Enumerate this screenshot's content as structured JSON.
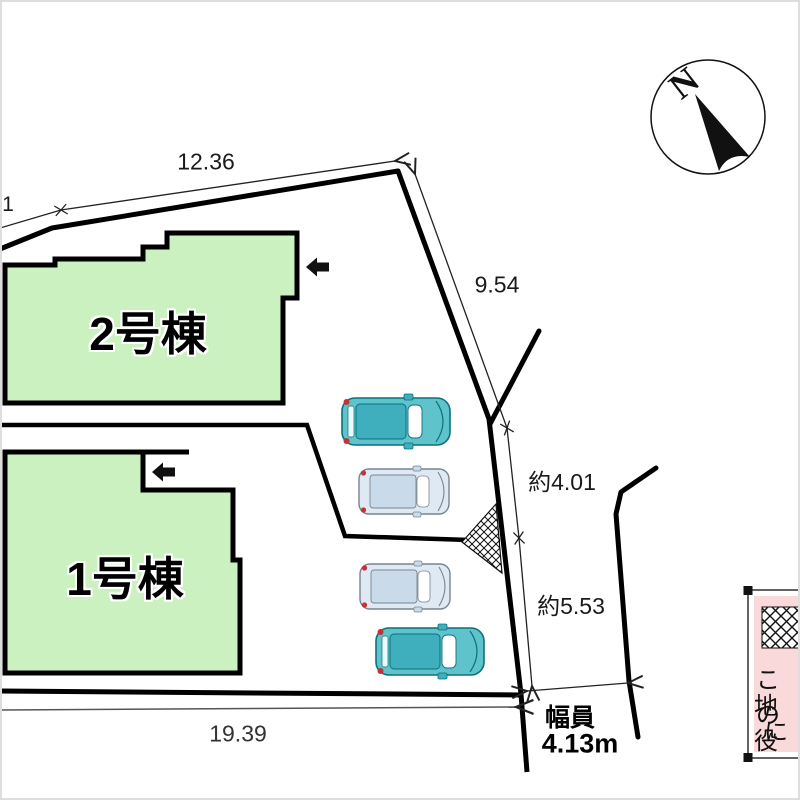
{
  "title": "site-plan",
  "buildings": [
    {
      "label": "2号棟"
    },
    {
      "label": "1号棟"
    }
  ],
  "dimensions": {
    "left_partial": "1",
    "top": "12.36",
    "right_upper": "9.54",
    "right_mid": "約4.01",
    "right_lower": "約5.53",
    "bottom": "19.39",
    "road_width_label": "幅員",
    "road_width_value": "4.13m"
  },
  "compass": {
    "north": "N"
  },
  "legend": {
    "lines": [
      "この",
      "地役",
      "に"
    ]
  },
  "colors": {
    "building_fill": "#cbf1c1",
    "line_black": "#000000",
    "dim_line": "#222222",
    "legend_pink": "#f9d9d9",
    "car_teal": "#5fc3cc",
    "car_teal_dark": "#3fafbd",
    "car_teal_stroke": "#0e6f7d",
    "car_light": "#dfe9f3",
    "car_light_dark": "#c9dbeb",
    "car_light_stroke": "#77858f",
    "marker_red": "#c23434",
    "frame_gray": "#dedede"
  }
}
